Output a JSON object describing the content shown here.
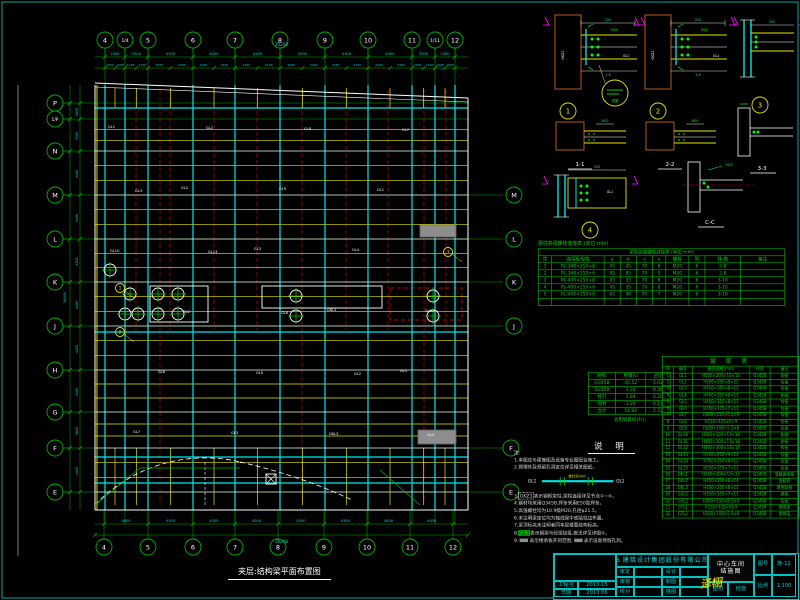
{
  "sheet": {
    "frame_color": "#00b8b8",
    "bg": "#000000"
  },
  "colors": {
    "grid": "#00b300",
    "beam_yellow": "#e6e600",
    "column_cyan": "#00e5e5",
    "main_white": "#e8e8e8",
    "red_dash": "#cc0000",
    "orange": "#c8641e",
    "magenta": "#ff00ff",
    "dim_text": "#00d8d8",
    "gray_fill": "#8d8d8d"
  },
  "plan": {
    "title": "夹层:结构梁平面布置图",
    "axes_top": [
      "4",
      "1/4",
      "5",
      "6",
      "7",
      "8",
      "9",
      "10",
      "11",
      "1/11",
      "12"
    ],
    "axes_bottom": [
      "4",
      "5",
      "6",
      "7",
      "8",
      "9",
      "10",
      "11",
      "12"
    ],
    "axes_left": [
      "P",
      "1/P",
      "N",
      "M",
      "L",
      "K",
      "J",
      "H",
      "G",
      "F",
      "E"
    ],
    "axes_right": [
      "M",
      "L",
      "K",
      "J",
      "F",
      "E"
    ],
    "dims_top": [
      "2500",
      "2300",
      "4500",
      "4200",
      "4200",
      "4500",
      "4300",
      "4400",
      "2300",
      "2000"
    ],
    "dim_total_top": "35200",
    "dims_bottom": [
      "4800",
      "4500",
      "4200",
      "4200",
      "4500",
      "4300",
      "4400",
      "4300"
    ],
    "dim_total_bottom": "35200",
    "dims_left": [
      "1600",
      "3200",
      "4400",
      "4400",
      "4300",
      "4400",
      "4400",
      "4200",
      "3600",
      "4400"
    ],
    "dim_total_left": "38900",
    "beam_labels": [
      "GL1",
      "GL2",
      "GL3",
      "GKL1",
      "GL5",
      "GL7",
      "GL2",
      "GL9",
      "GL4",
      "GL12",
      "GL6",
      "GL3",
      "GL8",
      "GL1",
      "GL10",
      "GL2",
      "GL5",
      "GKL2",
      "GL7",
      "GL3",
      "GL13",
      "GL6",
      "GL2",
      "GL4"
    ],
    "callouts": [
      "1",
      "2",
      "3"
    ]
  },
  "details": {
    "col_label": "GKZ1",
    "beam_label": "GL1",
    "bolt_label": "M20",
    "callout_note": "详图",
    "nums": [
      "1",
      "2",
      "3",
      "4"
    ],
    "sections": [
      "1-1",
      "2-2",
      "3-3",
      "C-C"
    ]
  },
  "bolt_table": {
    "title": "梁柱高强螺栓连接表 (单位:mm)",
    "headers": [
      "序",
      "连接板规格",
      "a",
      "b",
      "c",
      "e",
      "螺栓",
      "列",
      "排-数",
      "备注"
    ],
    "rows": [
      [
        "1",
        "PL-348×250×8",
        "45",
        "45",
        "70",
        "6",
        "M20",
        "6",
        "2-8",
        ""
      ],
      [
        "2",
        "PL-348×250×6",
        "45",
        "85",
        "70",
        "5",
        "M20",
        "6",
        "2-8",
        ""
      ],
      [
        "3",
        "PL-400×250×8",
        "45",
        "35",
        "70",
        "6",
        "M20",
        "6",
        "3-10",
        ""
      ],
      [
        "4",
        "PL-400×250×8",
        "45",
        "35",
        "70",
        "6",
        "M20",
        "6",
        "3-10",
        ""
      ],
      [
        "5",
        "PL-450×250×8",
        "45",
        "90",
        "70",
        "7",
        "M20",
        "6",
        "3-10",
        ""
      ],
      [
        "",
        "",
        "",
        "",
        "",
        "",
        "",
        "",
        "",
        ""
      ]
    ]
  },
  "steel_table": {
    "headers": [
      "材料",
      "用量(t)",
      "占比"
    ],
    "rows": [
      [
        "Q345B",
        "45.52",
        "5.02"
      ],
      [
        "Q235B",
        "3.28",
        "0.36"
      ],
      [
        "栓钉",
        "1.84",
        "0.20"
      ],
      [
        "焊材",
        "1.28",
        "0.14"
      ],
      [
        "合计",
        "51.92",
        "5.72"
      ]
    ],
    "caption": "总用钢量统计(t)",
    "notes_heading": "说  明"
  },
  "member_table": {
    "title": "钢  梁  表",
    "headers": [
      "序",
      "编号",
      "截面规格(mm)",
      "材质",
      "备注"
    ],
    "rows": [
      [
        "1",
        "GL1",
        "H500×200×10×16",
        "Q345B",
        "刚接"
      ],
      [
        "2",
        "GL2",
        "H500×200×8×12",
        "Q345B",
        "铰接"
      ],
      [
        "3",
        "GL3",
        "H450×200×8×12",
        "Q345B",
        "铰接"
      ],
      [
        "4",
        "GL4",
        "H400×200×8×13",
        "Q345B",
        "刚接"
      ],
      [
        "5",
        "GL5",
        "H400×150×8×13",
        "Q345B",
        "铰接"
      ],
      [
        "6",
        "GL6",
        "H350×175×7×11",
        "Q345B",
        "铰接"
      ],
      [
        "7",
        "GL7",
        "H300×150×6.5×9",
        "Q345B",
        "铰接"
      ],
      [
        "8",
        "GL8",
        "H250×125×6×9",
        "Q345B",
        "铰接"
      ],
      [
        "9",
        "GL9",
        "H200×100×5.5×8",
        "Q345B",
        "铰接"
      ],
      [
        "10",
        "GL10",
        "H500×300×11×18",
        "Q345B",
        "刚接"
      ],
      [
        "11",
        "GL11",
        "H450×300×11×18",
        "Q345B",
        "刚接"
      ],
      [
        "12",
        "GL12",
        "H400×300×10×16",
        "Q345B",
        "铰接"
      ],
      [
        "13",
        "GL13",
        "H350×250×9×14",
        "Q345B",
        "铰接"
      ],
      [
        "14",
        "GL14",
        "H300×200×8×12",
        "Q345B",
        "铰接"
      ],
      [
        "15",
        "GL15",
        "H250×175×7×11",
        "Q345B",
        "铰接"
      ],
      [
        "16",
        "GKL1",
        "H500×200×10×16",
        "Q345B",
        "变截面刚接"
      ],
      [
        "17",
        "GKL2",
        "H450×200×8×14",
        "Q345B",
        "变截面"
      ],
      [
        "18",
        "GKL3",
        "H400×200×8×13",
        "Q345B",
        "悬挑刚接"
      ],
      [
        "19",
        "GXL1",
        "H350×175×7×11",
        "Q345B",
        "悬挑"
      ],
      [
        "20",
        "GXL2",
        "H300×150×6.5×9",
        "Q345B",
        "铰接"
      ],
      [
        "21",
        "GTL1",
        "H250×125×6×9",
        "Q345B",
        "楼梯梁"
      ],
      [
        "22",
        "GTL2",
        "H200×100×5.5×8",
        "Q345B",
        "楼梯梁"
      ]
    ]
  },
  "notes": {
    "label": "注:",
    "items": [
      "1.本图应与建施图及设备专业图配合施工。",
      "2.预埋件及预留孔洞定位详见相关图纸。",
      "3.GKZ1表示钢框架柱,梁柱连接详见节点①~④。",
      "4.钢材均采用Q345B,焊条采用E50型焊条。",
      "5.高强螺栓均为10.9级M20,孔径φ21.5。",
      "6.未注明梁定位均为轴线居中或贴柱边布置。",
      "7.梁顶标高未注明者同本层楼面结构标高。",
      "8.GJL1表示钢梁与砼梁铰接,做法详见详图④。"
    ],
    "boxed": "GKZ1",
    "highlighted": "GJL1",
    "legend": [
      "表示楼承板开洞范围,",
      "表示设备预留孔洞。"
    ],
    "legend_prefix": "9.",
    "diagram_left": "GL1",
    "diagram_right": "GL1",
    "diagram_top": "栓钉@200"
  },
  "title_block": {
    "company": "建筑设计集团股份有限公司",
    "logo": "⚓",
    "job_no_label": "工程号",
    "job_no": "2013-15",
    "date_label": "日期",
    "date": "2013.06",
    "small_cells": [
      [
        "审定",
        ""
      ],
      [
        "审核",
        ""
      ],
      [
        "校对",
        ""
      ],
      [
        "设计",
        ""
      ],
      [
        "制图",
        ""
      ],
      [
        "描图",
        ""
      ]
    ],
    "signature": "泽栩",
    "project": "中心车间",
    "drawing": "结施图",
    "meta": [
      [
        "图别",
        "结施"
      ],
      [
        "图号",
        "施-12"
      ],
      [
        "比例",
        "1:100"
      ]
    ]
  }
}
